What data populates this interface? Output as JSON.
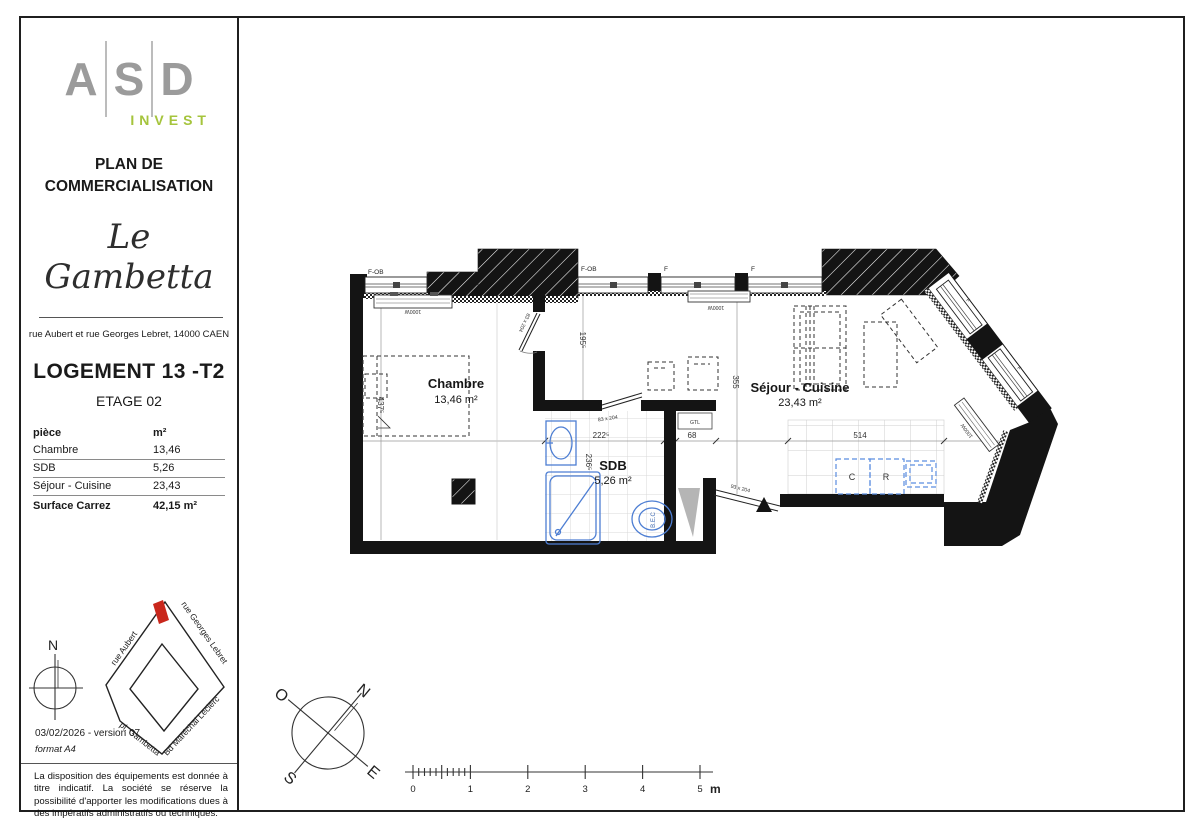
{
  "sidebar": {
    "logo": {
      "letters": [
        "A",
        "S",
        "D"
      ],
      "invest": "INVEST",
      "asd_color": "#9b9b9b",
      "invest_color": "#a5c43c"
    },
    "doc_title_line1": "PLAN DE",
    "doc_title_line2": "COMMERCIALISATION",
    "brand": "Le Gambetta",
    "address": "rue Aubert et rue Georges Lebret, 14000 CAEN",
    "unit": "LOGEMENT 13 -T2",
    "floor": "ETAGE 02",
    "table": {
      "col_piece": "pièce",
      "col_m2": "m²",
      "rows": [
        {
          "piece": "Chambre",
          "m2": "13,46"
        },
        {
          "piece": "SDB",
          "m2": "5,26"
        },
        {
          "piece": "Séjour - Cuisine",
          "m2": "23,43"
        }
      ],
      "total_label": "Surface Carrez",
      "total_value": "42,15 m²"
    },
    "map": {
      "north": "N",
      "streets": {
        "nw": "rue Aubert",
        "ne": "rue Georges Lebret",
        "sw": "pl. Gambetta",
        "se": "Bd Maréchal Leclerc"
      },
      "marker_color": "#c9271c"
    },
    "date_version": "03/02/2026 - version 07",
    "format_note": "format A4",
    "disclaimer": "La disposition des équipements est donnée à titre indicatif. La société se réserve la possibilité d'apporter les modifications dues à des impératifs administratifs ou techniques."
  },
  "plan": {
    "rooms": {
      "chambre": {
        "name": "Chambre",
        "area": "13,46 m²"
      },
      "sdb": {
        "name": "SDB",
        "area": "5,26 m²"
      },
      "sejour": {
        "name": "Séjour - Cuisine",
        "area": "23,43 m²"
      }
    },
    "openings": {
      "window_fob": "F-OB",
      "window_f": "F",
      "door_interior": "83 x 204",
      "door_entry": "93 x 204"
    },
    "equipment": {
      "radiator": "1000W",
      "gtl": "GTL",
      "water_heater": "B.E.C",
      "kitchen_c": "C",
      "kitchen_r": "R"
    },
    "dimensions": {
      "d437": "437⁵",
      "d195": "195⁵",
      "d222": "222⁵",
      "d236": "236⁵",
      "d68": "68",
      "d355": "355",
      "d514": "514"
    },
    "colors": {
      "fixtures": "#4d7ed3"
    }
  },
  "compass": {
    "o": "O",
    "n": "N",
    "s": "S",
    "e": "E"
  },
  "scalebar": {
    "labels": [
      "0",
      "1",
      "2",
      "3",
      "4",
      "5"
    ],
    "unit": "m"
  }
}
